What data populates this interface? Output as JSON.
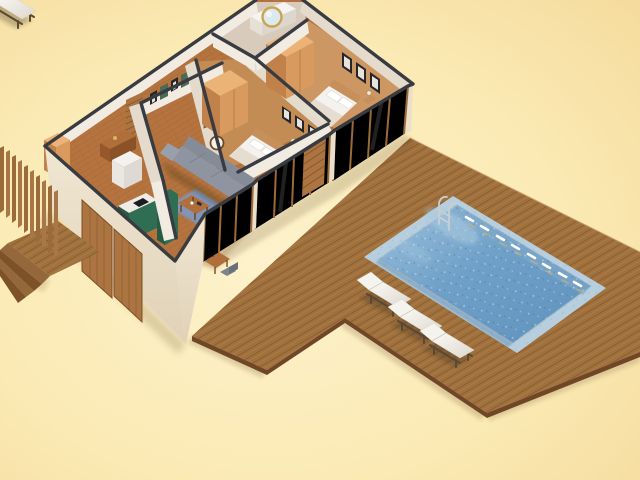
{
  "scene": {
    "description": "Isometric 3D cutaway render of a furnished single-storey house with a wooden pool deck, rectangular swimming pool with ladder, and three white sun loungers on a plain cream background",
    "projection": "isometric-cutaway-3d-render",
    "background": {
      "center": "#fdf2cc",
      "edge": "#f6dfa2"
    }
  },
  "palette": {
    "deck": "#a0713d",
    "deckEdge": "#6f4726",
    "poolRim": "#b6cedd",
    "water1": "#8fb8d8",
    "water2": "#5f92bc",
    "wallTop": "#383b40",
    "wallFace": "#f1ebe2",
    "wallFaceShade": "#e4dbcd",
    "extWall": "#eadfca",
    "woodFrame": "#9c6a38",
    "parquet": "#b5743f",
    "bedroomFloorA": "#cd9763",
    "bedroomFloorB": "#c48c55",
    "bathFloor": "#d9cbbc",
    "wardrobeFront": "#d89a5f",
    "wardrobeSide": "#c0824a",
    "wardrobeTop": "#ecb377",
    "sofa": "#8f95a0",
    "sofaBack": "#868c97",
    "rug": "#7e97c2",
    "kitchenGreen": "#2f6e53",
    "kitchenGreenDark": "#265c44",
    "counter": "#eeece6",
    "cushion": "#f5f3ee",
    "loungerFrame": "#5a4833",
    "metal": "#c9ced3",
    "mirrorGold": "#c9a54f",
    "pictureFrame": "#26262a",
    "tableWood": "#b06f3a",
    "doorWood": "#ab7440",
    "glint": "#d9b465",
    "bedLinen": "#f4f2ee",
    "headboard": "#c6905c"
  },
  "house": {
    "rooms": [
      {
        "name": "bathroom",
        "features": [
          "round-gold-mirror",
          "white-vanity-sink",
          "dark-wall-cabinet"
        ]
      },
      {
        "name": "bedroom-right",
        "features": [
          "double-bed-white-linen",
          "orange-wardrobe",
          "three-picture-frames",
          "nightstand-with-lamp"
        ]
      },
      {
        "name": "bedroom-middle",
        "features": [
          "double-bed-white-linen",
          "orange-wardrobe",
          "three-picture-frames",
          "nightstand-with-lamp"
        ]
      },
      {
        "name": "hallway",
        "features": [
          "gallery-picture-frames",
          "wood-slat-panel",
          "console-table",
          "small-wardrobe"
        ]
      },
      {
        "name": "living-room",
        "features": [
          "gray-sofa",
          "wood-wall-shelf",
          "wall-clock",
          "coffee-table",
          "blue-rug",
          "herringbone-parquet"
        ]
      },
      {
        "name": "kitchen",
        "features": [
          "dark-green-cabinets",
          "white-counter",
          "black-cooktop",
          "white-appliance-box"
        ]
      },
      {
        "name": "dining-area",
        "features": [
          "wood-table",
          "gray-chairs"
        ]
      }
    ],
    "exterior": [
      "glass-sliding-front-walls",
      "wood-sliding-doors",
      "vertical-slat-fence",
      "entry-porch-steps"
    ]
  },
  "deck": {
    "material": "wood-planks",
    "shape": "L-shaped-around-pool"
  },
  "pool": {
    "water": "blue-sparkling",
    "rim": "light-blue-tile",
    "ladder": true,
    "underwater_lights": 8
  },
  "loungers": {
    "count": 3,
    "cushion": "white",
    "frame": "dark-bronze"
  }
}
